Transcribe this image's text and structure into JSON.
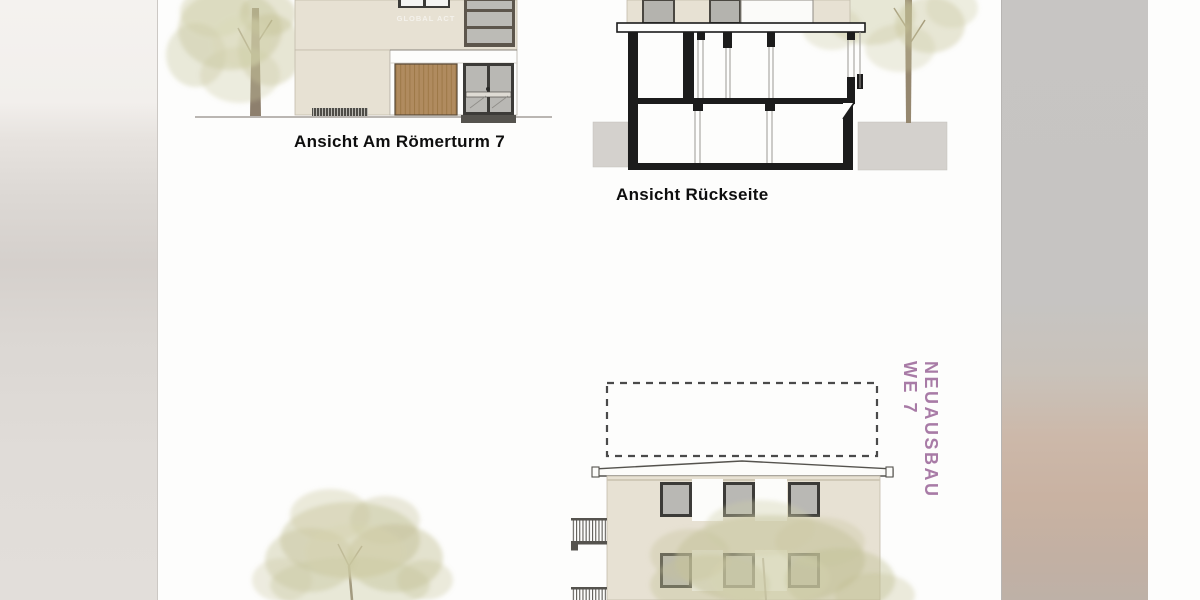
{
  "document": {
    "kind": "architectural-drawing-sheet",
    "watermark": "GLOBAL ACT",
    "drawings": [
      {
        "id": "elevation-am-roemerturm-7",
        "caption": "Ansicht Am Römerturm 7"
      },
      {
        "id": "section-rueckseite",
        "caption": "Ansicht Rückseite"
      },
      {
        "id": "elevation-neuausbau",
        "annotation_line1": "NEUAUSBAU",
        "annotation_line2": "WE 7"
      }
    ]
  },
  "colors": {
    "facade_beige": "#e7e1d3",
    "window_glass": "#b9b8b4",
    "window_frame": "#3c3b38",
    "garage_wood": "#b08b5f",
    "section_ink": "#1c1c1c",
    "ground_gray": "#d4d1cd",
    "annotation_purple": "#a87ba6",
    "caption_black": "#0e0e0e",
    "foliage_green": "#c6c49c",
    "blur_band_left": "#dbd7d3",
    "blur_band_right": "#c6c4c2"
  }
}
